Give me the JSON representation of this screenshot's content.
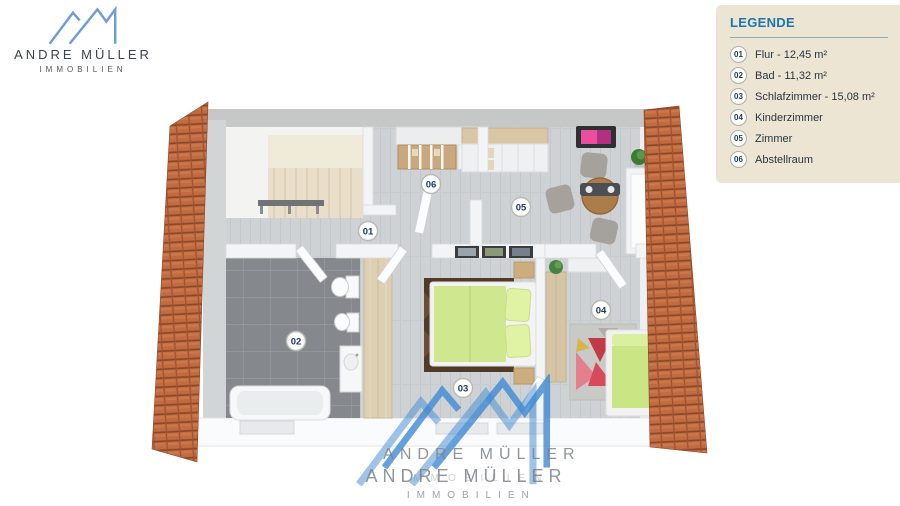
{
  "theme": {
    "brand-blue": "#6f9bd8",
    "logo-text": "#3d434b",
    "logo-sub": "#51565d",
    "legend-bg": "#ece5d3",
    "legend-title": "#1b75b1",
    "legend-text": "#2a3440",
    "roof-orange": "#c06b42",
    "floor-gray": "#cfd2d4",
    "bath-tile": "#85898d",
    "bed-green": "#cfe78f",
    "accent-pink": "#d9368b",
    "watermark-gray": "#8e939b"
  },
  "logo": {
    "name": "ANDRE MÜLLER",
    "tagline": "IMMOBILIEN"
  },
  "legend": {
    "title": "LEGENDE",
    "items": [
      {
        "num": "01",
        "label": "Flur - 12,45 m²"
      },
      {
        "num": "02",
        "label": "Bad - 11,32 m²"
      },
      {
        "num": "03",
        "label": "Schlafzimmer - 15,08 m²"
      },
      {
        "num": "04",
        "label": "Kinderzimmer"
      },
      {
        "num": "05",
        "label": "Zimmer"
      },
      {
        "num": "06",
        "label": "Abstellraum"
      }
    ]
  },
  "plan": {
    "badges": [
      {
        "num": "01"
      },
      {
        "num": "02"
      },
      {
        "num": "03"
      },
      {
        "num": "04"
      },
      {
        "num": "05"
      },
      {
        "num": "06"
      }
    ]
  },
  "watermark": {
    "name": "ANDRE MÜLLER",
    "tagline": "IMMOBILIEN"
  }
}
